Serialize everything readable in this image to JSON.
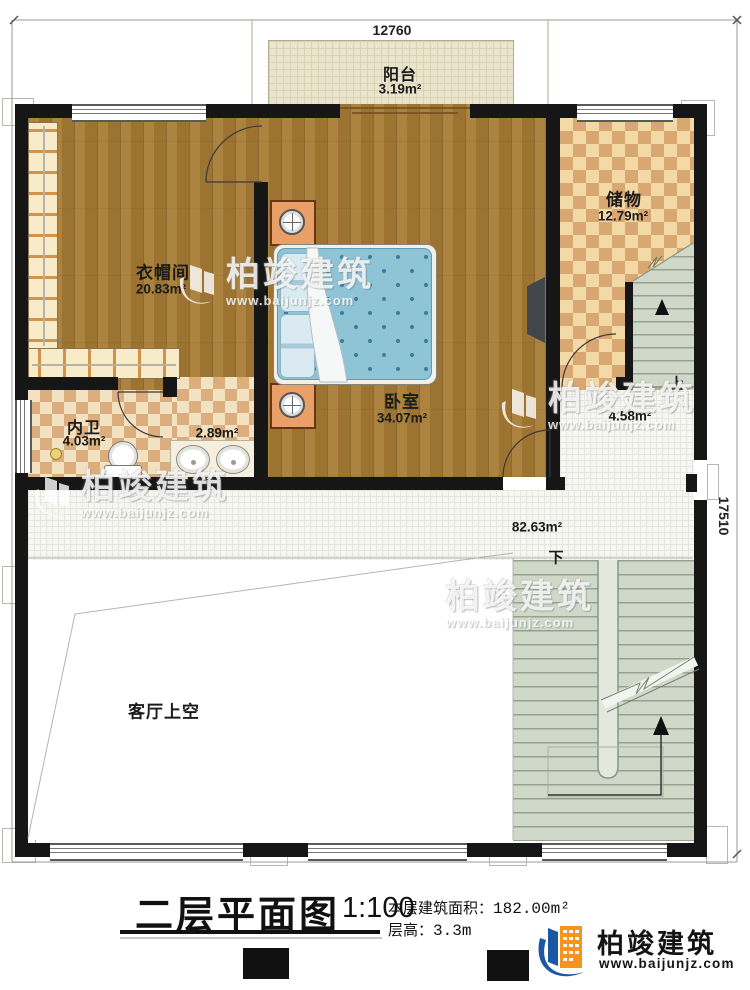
{
  "plan": {
    "dim_top": "12760",
    "dim_right": "17510",
    "rooms": {
      "balcony": {
        "name": "阳台",
        "area": "3.19m²"
      },
      "storage": {
        "name": "储物",
        "area": "12.79m²"
      },
      "cloakroom": {
        "name": "衣帽间",
        "area": "20.83m²"
      },
      "bedroom": {
        "name": "卧室",
        "area": "34.07m²"
      },
      "bathroom": {
        "name": "内卫",
        "area": "4.03m²"
      },
      "vanity": {
        "area": "2.89m²"
      },
      "hall": {
        "area": "82.63m²"
      },
      "landing": {
        "area": "4.58m²"
      },
      "void": {
        "name": "客厅上空"
      }
    },
    "stair_up_label": "上",
    "stair_down_label": "下"
  },
  "watermark": {
    "brand": "柏竣建筑",
    "url": "www.baijunjz.com"
  },
  "footer": {
    "title": "二层平面图",
    "scale": "1:100",
    "area_label": "本层建筑面积：",
    "area_value": "182.00m²",
    "height_label": "层高：",
    "height_value": "3.3m",
    "brand": "柏竣建筑",
    "brand_url": "www.baijunjz.com"
  }
}
